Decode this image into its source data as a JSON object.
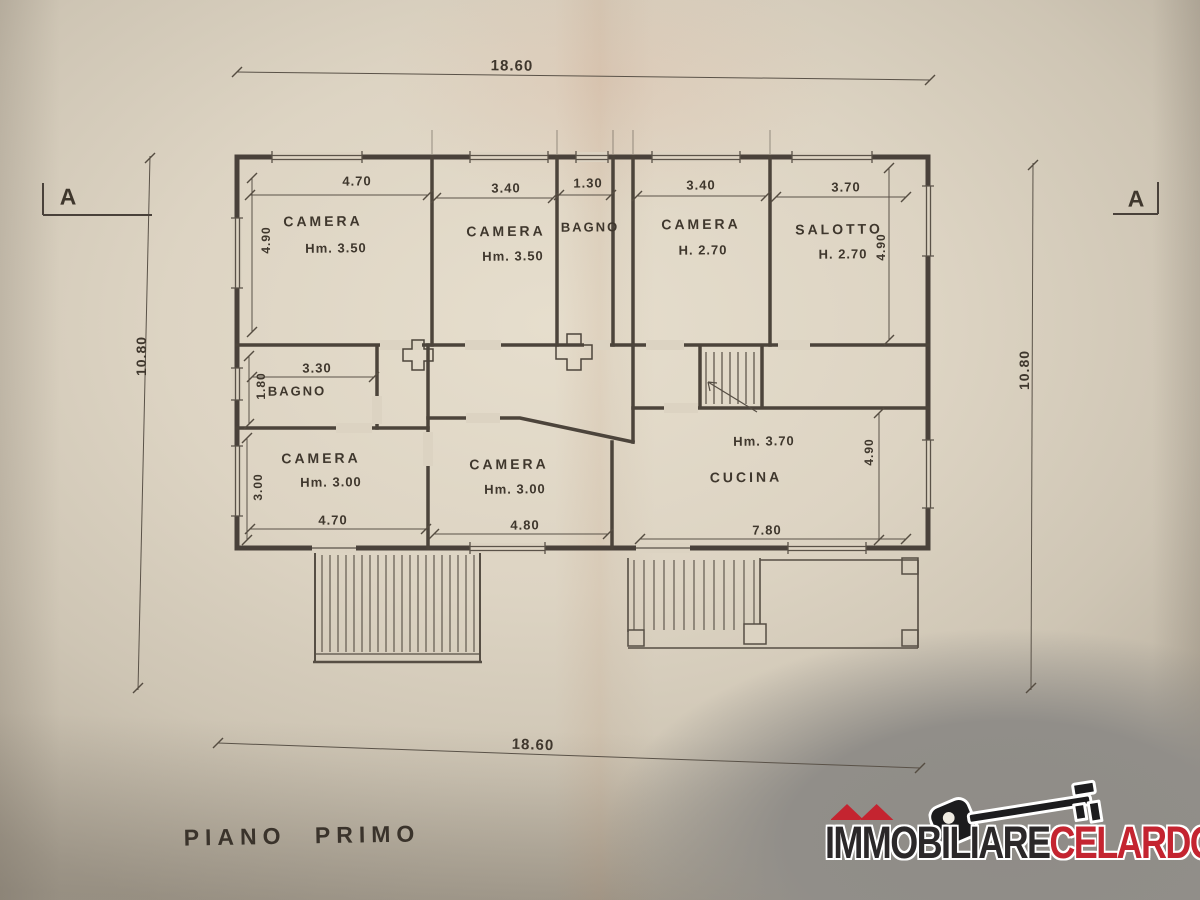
{
  "title": "PIANO PRIMO",
  "section_markers": {
    "left": "A",
    "right": "A"
  },
  "overall_dims": {
    "top": "18.60",
    "bottom": "18.60",
    "left": "10.80",
    "right": "10.80"
  },
  "rooms": [
    {
      "name": "CAMERA",
      "height": "Hm. 3.50",
      "width": "4.70",
      "depth": "4.90"
    },
    {
      "name": "CAMERA",
      "height": "Hm. 3.50",
      "width": "3.40",
      "depth": ""
    },
    {
      "name": "BAGNO",
      "height": "",
      "width": "1.30",
      "depth": ""
    },
    {
      "name": "CAMERA",
      "height": "H. 2.70",
      "width": "3.40",
      "depth": ""
    },
    {
      "name": "SALOTTO",
      "height": "H. 2.70",
      "width": "3.70",
      "depth": "4.90"
    },
    {
      "name": "BAGNO",
      "height": "",
      "width": "3.30",
      "depth": "1.80"
    },
    {
      "name": "CAMERA",
      "height": "Hm. 3.00",
      "width": "4.70",
      "depth": "3.00"
    },
    {
      "name": "CAMERA",
      "height": "Hm. 3.00",
      "width": "4.80",
      "depth": ""
    },
    {
      "name": "CUCINA",
      "height": "Hm. 3.70",
      "width": "7.80",
      "depth": "4.90"
    }
  ],
  "logo": {
    "prefix": "I",
    "mm": "MM",
    "suffix": "OBILIARE",
    "accent": "CELARDO",
    "registered": "®",
    "color_dark": "#2b2829",
    "color_accent": "#c42430"
  }
}
